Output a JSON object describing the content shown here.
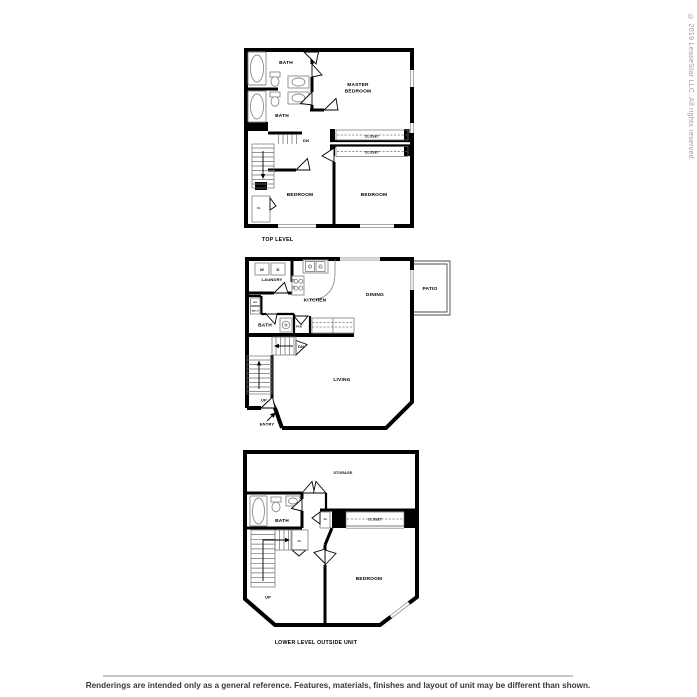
{
  "copyright": "© 2019 LeaseStar LLC. All rights reserved.",
  "footer": {
    "disclaimer": "Renderings are intended only as a general reference. Features, materials, finishes and layout of unit may be different than shown."
  },
  "colors": {
    "wall": "#000000",
    "fixture_line": "#8a8a8a",
    "window_line": "#9a9a9a",
    "copyright_text": "#9b9b9b",
    "disclaimer_text": "#3a3a3a",
    "divider_line": "#c8c8c8"
  },
  "icons": {
    "down_arrow": "down-direction-arrow",
    "up_arrow": "up-direction-arrow",
    "entry_arrow": "entry-direction-arrow"
  },
  "floors": {
    "top": {
      "caption": "TOP LEVEL",
      "labels": {
        "bath1": "BATH",
        "bath2": "BATH",
        "master_line1": "MASTER",
        "master_line2": "BEDROOM",
        "dn": "DN",
        "closet1": "CLOSET",
        "closet2": "CLOSET",
        "bedroom1": "BEDROOM",
        "bedroom2": "BEDROOM",
        "cl": "CL"
      }
    },
    "middle": {
      "labels": {
        "washer": "W",
        "dryer": "D",
        "laundry": "LAUNDRY",
        "kitchen": "KITCHEN",
        "dining": "DINING",
        "patio": "PATIO",
        "wh": "WH",
        "mech": "MECH",
        "bath": "BATH",
        "pan": "PAN",
        "dn": "DN",
        "up": "UP",
        "living": "LIVING",
        "entry": "ENTRY"
      }
    },
    "lower": {
      "caption": "LOWER LEVEL OUTSIDE UNIT",
      "labels": {
        "storage": "STORAGE",
        "bath": "BATH",
        "cl1": "CL",
        "cl2": "CL",
        "closet": "CLOSET",
        "bedroom": "BEDROOM",
        "up": "UP"
      }
    }
  }
}
